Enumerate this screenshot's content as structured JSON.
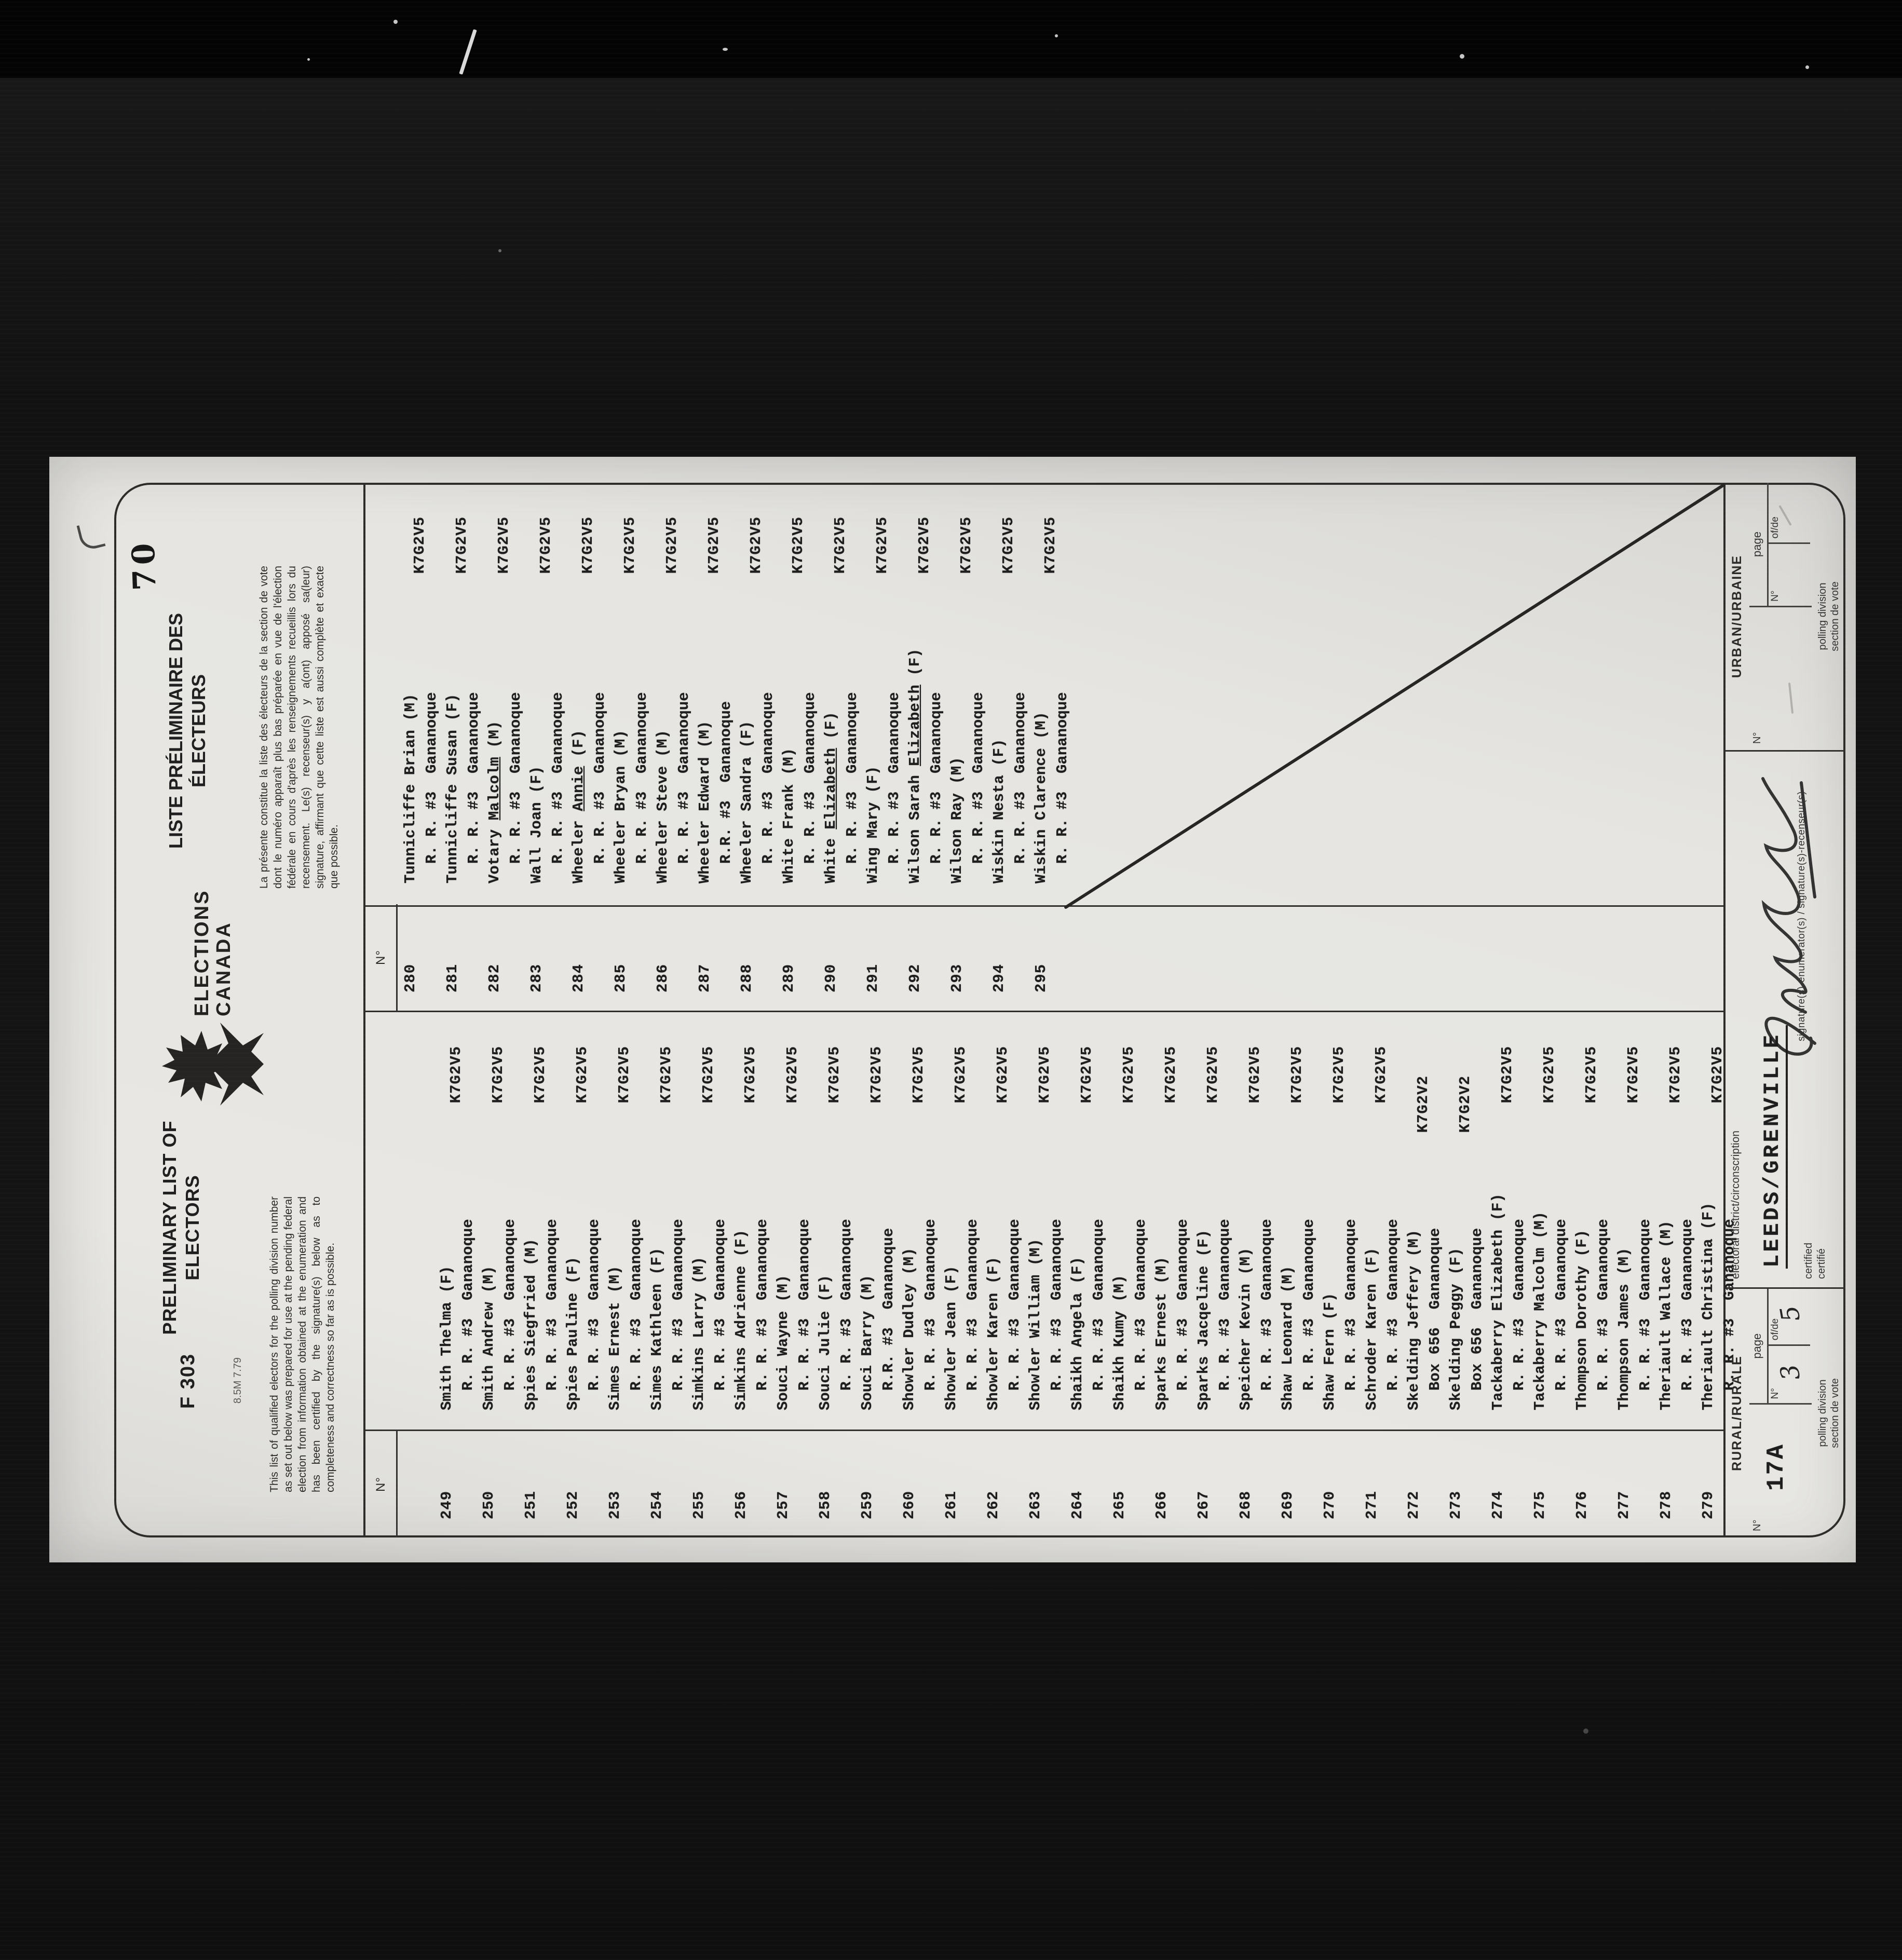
{
  "colors": {
    "film_background": "#0e0e0e",
    "paper": "#e6e5e1",
    "ink": "#1d1d1d"
  },
  "page": {
    "stamp": "70",
    "header": {
      "form_number": "F 303",
      "print_code": "8.5M 7.79",
      "title_en_line1": "PRELIMINARY LIST OF",
      "title_en_line2": "ELECTORS",
      "paragraph_en": "This list of qualified electors for the polling division number as set out below was prepared for use at the pending federal election from information obtained at the enumeration and has been certified by the signature(s) below as to completeness and correctness so far as is possible.",
      "logo_line1": "ELECTIONS",
      "logo_line2": "CANADA",
      "title_fr_line1": "LISTE PRÉLIMINAIRE DES",
      "title_fr_line2": "ÉLECTEURS",
      "paragraph_fr": "La présente constitue la liste des électeurs de la section de vote dont le numéro apparaît plus bas préparée en vue de l'élection fédérale en cours d'après les renseignements recueillis lors du recensement. Le(s) recenseur(s) y a(ont) apposé sa(leur) signature, affirmant que cette liste est aussi complète et exacte que possible."
    },
    "list": {
      "col_header": "N°",
      "left_column": [
        {
          "no": "249",
          "surname": "Smith",
          "given": "Thelma",
          "sex": "F",
          "address": "R. R. #3  Gananoque",
          "postal": "K7G2V5"
        },
        {
          "no": "250",
          "surname": "Smith",
          "given": "Andrew",
          "sex": "M",
          "address": "R. R. #3  Gananoque",
          "postal": "K7G2V5"
        },
        {
          "no": "251",
          "surname": "Spies",
          "given": "Siegfried",
          "sex": "M",
          "address": "R. R. #3  Gananoque",
          "postal": "K7G2V5"
        },
        {
          "no": "252",
          "surname": "Spies",
          "given": "Pauline",
          "sex": "F",
          "address": "R. R. #3  Gananoque",
          "postal": "K7G2V5"
        },
        {
          "no": "253",
          "surname": "Simes",
          "given": "Ernest",
          "sex": "M",
          "address": "R. R. #3  Gananoque",
          "postal": "K7G2V5"
        },
        {
          "no": "254",
          "surname": "Simes",
          "given": "Kathleen",
          "sex": "F",
          "address": "R. R. #3  Gananoque",
          "postal": "K7G2V5"
        },
        {
          "no": "255",
          "surname": "Simkins",
          "given": "Larry",
          "sex": "M",
          "address": "R. R. #3  Gananoque",
          "postal": "K7G2V5"
        },
        {
          "no": "256",
          "surname": "Simkins",
          "given": "Adrienne",
          "sex": "F",
          "address": "R. R. #3  Gananoque",
          "postal": "K7G2V5"
        },
        {
          "no": "257",
          "surname": "Souci",
          "given": "Wayne",
          "sex": "M",
          "address": "R. R. #3  Gananoque",
          "postal": "K7G2V5"
        },
        {
          "no": "258",
          "surname": "Souci",
          "given": "Julie",
          "sex": "F",
          "address": "R. R. #3  Gananoque",
          "postal": "K7G2V5"
        },
        {
          "no": "259",
          "surname": "Souci",
          "given": "Barry",
          "sex": "M",
          "address": "R.R. #3  Gananoque",
          "postal": "K7G2V5"
        },
        {
          "no": "260",
          "surname": "Showler",
          "given": "Dudley",
          "sex": "M",
          "address": "R. R. #3  Gananoque",
          "postal": "K7G2V5"
        },
        {
          "no": "261",
          "surname": "Showler",
          "given": "Jean",
          "sex": "F",
          "address": "R. R. #3  Gananoque",
          "postal": "K7G2V5"
        },
        {
          "no": "262",
          "surname": "Showler",
          "given": "Karen",
          "sex": "F",
          "address": "R. R. #3  Gananoque",
          "postal": "K7G2V5"
        },
        {
          "no": "263",
          "surname": "Showler",
          "given": "William",
          "sex": "M",
          "address": "R. R. #3  Gananoque",
          "postal": "K7G2V5"
        },
        {
          "no": "264",
          "surname": "Shaikh",
          "given": "Angela",
          "sex": "F",
          "address": "R. R. #3  Gananoque",
          "postal": "K7G2V5"
        },
        {
          "no": "265",
          "surname": "Shaikh",
          "given": "Kumy",
          "sex": "M",
          "address": "R. R. #3  Gananoque",
          "postal": "K7G2V5"
        },
        {
          "no": "266",
          "surname": "Sparks",
          "given": "Ernest",
          "sex": "M",
          "address": "R. R. #3  Gananoque",
          "postal": "K7G2V5"
        },
        {
          "no": "267",
          "surname": "Sparks",
          "given": "Jacqeline",
          "sex": "F",
          "address": "R. R. #3  Gananoque",
          "postal": "K7G2V5"
        },
        {
          "no": "268",
          "surname": "Speicher",
          "given": "Kevin",
          "sex": "M",
          "address": "R. R. #3  Gananoque",
          "postal": "K7G2V5"
        },
        {
          "no": "269",
          "surname": "Shaw",
          "given": "Leonard",
          "sex": "M",
          "address": "R. R. #3  Gananoque",
          "postal": "K7G2V5"
        },
        {
          "no": "270",
          "surname": "Shaw",
          "given": "Fern",
          "sex": "F",
          "address": "R. R. #3  Gananoque",
          "postal": "K7G2V5"
        },
        {
          "no": "271",
          "surname": "Schroder",
          "given": "Karen",
          "sex": "F",
          "address": "R. R. #3  Gananoque",
          "postal": "K7G2V5"
        },
        {
          "no": "272",
          "surname": "Skelding",
          "given": "Jeffery",
          "sex": "M",
          "address": "Box 656  Gananoque",
          "postal": "K7G2V2",
          "shift": true
        },
        {
          "no": "273",
          "surname": "Skelding",
          "given": "Peggy",
          "sex": "F",
          "address": "Box 656  Gananoque",
          "postal": "K7G2V2",
          "shift": true
        },
        {
          "no": "274",
          "surname": "Tackaberry",
          "given": "Elizabeth",
          "sex": "F",
          "address": "R. R. #3  Gananoque",
          "postal": "K7G2V5"
        },
        {
          "no": "275",
          "surname": "Tackaberry",
          "given": "Malcolm",
          "sex": "M",
          "address": "R. R. #3  Gananoque",
          "postal": "K7G2V5"
        },
        {
          "no": "276",
          "surname": "Thompson",
          "given": "Dorothy",
          "sex": "F",
          "address": "R. R. #3  Gananoque",
          "postal": "K7G2V5"
        },
        {
          "no": "277",
          "surname": "Thompson",
          "given": "James",
          "sex": "M",
          "address": "R. R. #3  Gananoque",
          "postal": "K7G2V5"
        },
        {
          "no": "278",
          "surname": "Theriault",
          "given": "Wallace",
          "sex": "M",
          "address": "R. R. #3  Gananoque",
          "postal": "K7G2V5"
        },
        {
          "no": "279",
          "surname": "Theriault",
          "given": "Christina",
          "sex": "F",
          "address": "R. R. #3  Gananoque",
          "postal": "K7G2V5"
        }
      ],
      "right_column": [
        {
          "no": "280",
          "surname": "Tunnicliffe",
          "given": "Brian",
          "sex": "M",
          "address": "R. R. #3  Gananoque",
          "postal": "K7G2V5"
        },
        {
          "no": "281",
          "surname": "Tunnicliffe",
          "given": "Susan",
          "sex": "F",
          "address": "R. R. #3  Gananoque",
          "postal": "K7G2V5"
        },
        {
          "no": "282",
          "surname": "Votary",
          "given": "Malcolm",
          "sex": "M",
          "address": "R. R. #3  Gananoque",
          "postal": "K7G2V5",
          "ul": true
        },
        {
          "no": "283",
          "surname": "Wall",
          "given": "Joan",
          "sex": "F",
          "address": "R. R. #3  Gananoque",
          "postal": "K7G2V5"
        },
        {
          "no": "284",
          "surname": "Wheeler",
          "given": "Annie",
          "sex": "F",
          "address": "R. R. #3  Gananoque",
          "postal": "K7G2V5",
          "ul": true
        },
        {
          "no": "285",
          "surname": "Wheeler",
          "given": "Bryan",
          "sex": "M",
          "address": "R. R. #3  Gananoque",
          "postal": "K7G2V5"
        },
        {
          "no": "286",
          "surname": "Wheeler",
          "given": "Steve",
          "sex": "M",
          "address": "R. R. #3  Gananoque",
          "postal": "K7G2V5"
        },
        {
          "no": "287",
          "surname": "Wheeler",
          "given": "Edward",
          "sex": "M",
          "address": "R.R. #3  Gananoque",
          "postal": "K7G2V5"
        },
        {
          "no": "288",
          "surname": "Wheeler",
          "given": "Sandra",
          "sex": "F",
          "address": "R. R. #3  Gananoque",
          "postal": "K7G2V5"
        },
        {
          "no": "289",
          "surname": "White",
          "given": "Frank",
          "sex": "M",
          "address": "R. R. #3  Gananoque",
          "postal": "K7G2V5"
        },
        {
          "no": "290",
          "surname": "White",
          "given": "Elizabeth",
          "sex": "F",
          "address": "R. R. #3  Gananoque",
          "postal": "K7G2V5",
          "ul": true
        },
        {
          "no": "291",
          "surname": "Wing",
          "given": "Mary",
          "sex": "F",
          "address": "R. R. #3  Gananoque",
          "postal": "K7G2V5"
        },
        {
          "no": "292",
          "surname": "Wilson",
          "given": "Sarah Elizabeth",
          "sex": "F",
          "address": "R. R. #3  Gananoque",
          "postal": "K7G2V5",
          "ul": true
        },
        {
          "no": "293",
          "surname": "Wilson",
          "given": "Ray",
          "sex": "M",
          "address": "R. R. #3  Gananoque",
          "postal": "K7G2V5"
        },
        {
          "no": "294",
          "surname": "Wiskin",
          "given": "Nesta",
          "sex": "F",
          "address": "R. R. #3  Gananoque",
          "postal": "K7G2V5"
        },
        {
          "no": "295",
          "surname": "Wiskin",
          "given": "Clarence",
          "sex": "M",
          "address": "R. R. #3  Gananoque",
          "postal": "K7G2V5"
        }
      ]
    },
    "footer": {
      "rural": {
        "title": "RURAL/RURALE",
        "no_label": "N°",
        "no_value": "17A",
        "page_label": "page",
        "page_no_label": "N°",
        "page_no_value": "3",
        "of_label": "of/de",
        "of_value": "5",
        "caption_line1": "polling division",
        "caption_line2": "section de vote"
      },
      "district_label": "electoral district/circonscription",
      "district_value": "LEEDS/GRENVILLE",
      "certified_line1": "certified",
      "certified_line2": "certifié",
      "signature_label": "signature(s)-enumerator(s) / signature(s)-recenseur(s)",
      "urban": {
        "title": "URBAN/URBAINE",
        "no_label": "N°",
        "no_value": "",
        "page_label": "page",
        "page_no_label": "N°",
        "page_no_value": "",
        "of_label": "of/de",
        "of_value": "",
        "caption_line1": "polling division",
        "caption_line2": "section de vote"
      }
    }
  }
}
